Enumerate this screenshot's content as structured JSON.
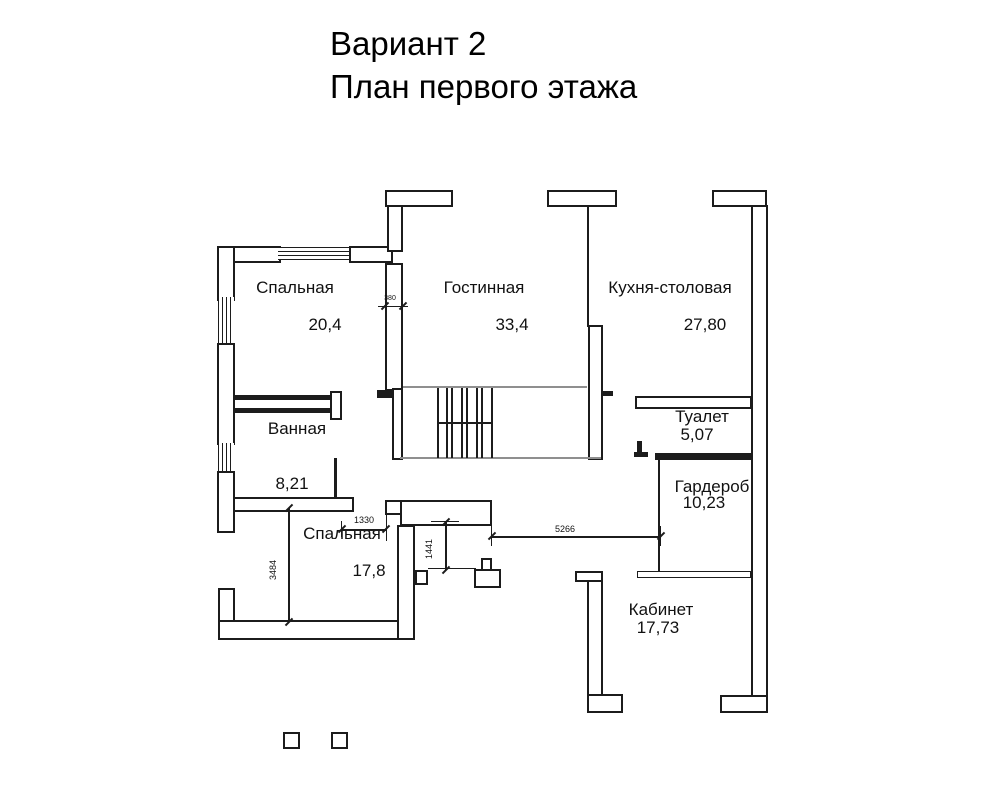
{
  "title": {
    "line1": "Вариант 2",
    "line2": "План первого этажа"
  },
  "rooms": [
    {
      "label": "Спальная",
      "area": "20,4"
    },
    {
      "label": "Гостинная",
      "area": "33,4"
    },
    {
      "label": "Кухня-столовая",
      "area": "27,80"
    },
    {
      "label": "Ванная",
      "area": "8,21"
    },
    {
      "label": "Туалет",
      "area": "5,07"
    },
    {
      "label": "Гардероб",
      "area": "10,23"
    },
    {
      "label": "Спальная",
      "area": "17,8"
    },
    {
      "label": "Кабинет",
      "area": "17,73"
    }
  ],
  "dimensions": {
    "wall_thickness": "380",
    "bath_door_width": "1330",
    "hall_opening_width": "1441",
    "bedroom_depth": "3484",
    "hall_length": "5266"
  },
  "colors": {
    "line": "#1c1c1c",
    "floor_line": "#8f8f8f",
    "background": "#ffffff"
  }
}
